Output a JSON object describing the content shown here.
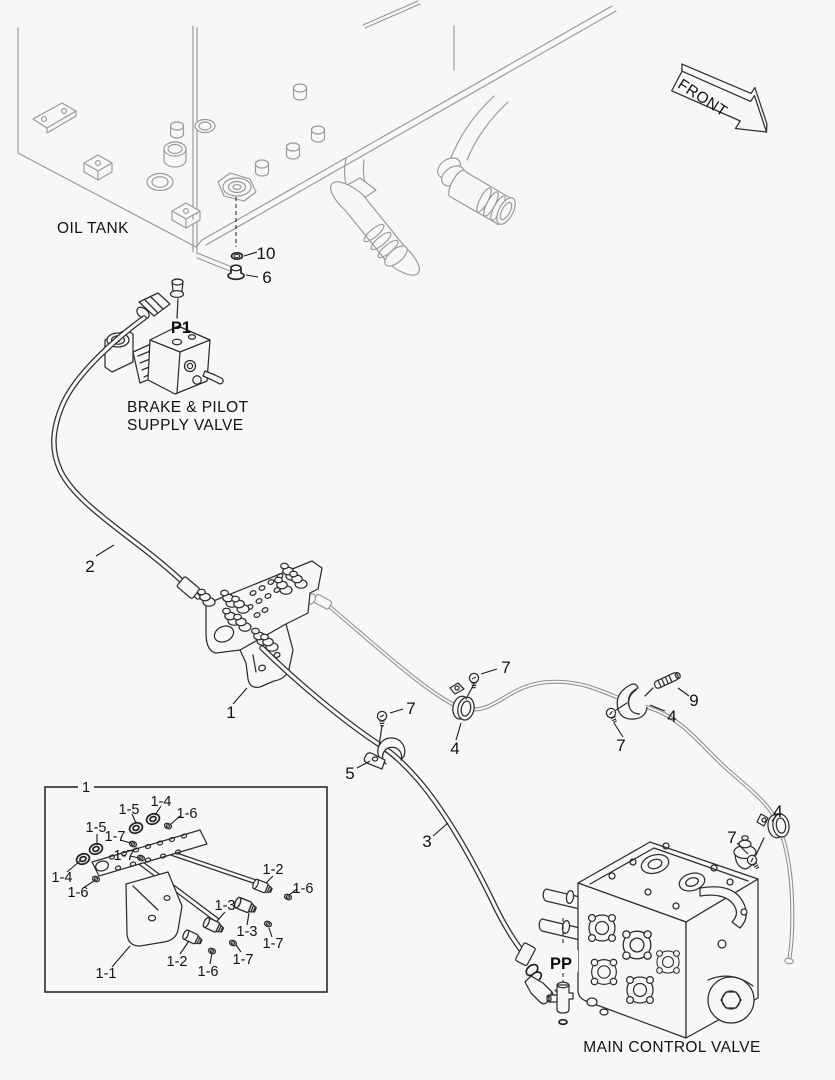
{
  "labels": {
    "front": "FRONT",
    "oil_tank": "OIL TANK",
    "brake_pilot_line1": "BRAKE & PILOT",
    "brake_pilot_line2": "SUPPLY VALVE",
    "main_control_valve": "MAIN CONTROL VALVE",
    "p1": "P1",
    "pp": "PP"
  },
  "callouts": {
    "item1": "1",
    "item2": "2",
    "item3": "3",
    "item4": "4",
    "item5": "5",
    "item6": "6",
    "item7": "7",
    "item9": "9",
    "item10": "10"
  },
  "inset": {
    "assembly": "1",
    "i1_1": "1-1",
    "i1_2": "1-2",
    "i1_3": "1-3",
    "i1_4": "1-4",
    "i1_5": "1-5",
    "i1_6": "1-6",
    "i1_7": "1-7"
  },
  "colors": {
    "background": "#f7f7f7",
    "line_dark": "#2e2e2e",
    "line_gray": "#989898",
    "text": "#121212"
  }
}
